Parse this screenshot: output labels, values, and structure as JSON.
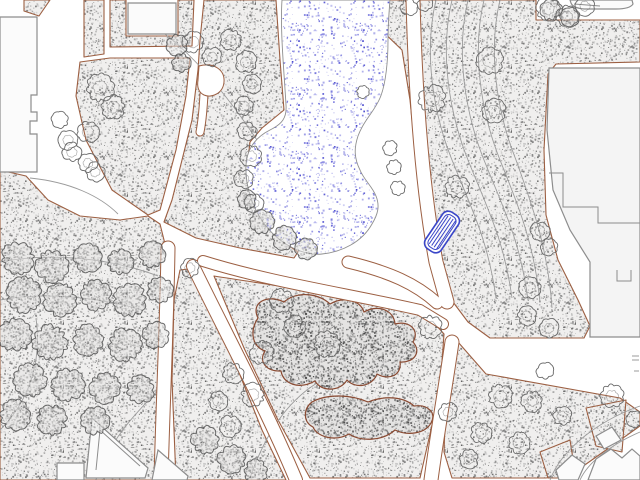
{
  "drawing": {
    "name": "park-site-plan",
    "viewport": {
      "w": 640,
      "h": 480
    }
  },
  "colors": {
    "paper": "#ffffff",
    "ground_base": "#f0efee",
    "ground_dots": [
      "#5c5c5c",
      "#7d7d7d",
      "#989898",
      "#b3b3b3",
      "#6e6e6e"
    ],
    "dark_base": "#e4e3e2",
    "dark_dots": [
      "#3d3d3d",
      "#565656",
      "#6f6f6f",
      "#8a8a8a"
    ],
    "pond_base": "#ffffff",
    "pond_dots": [
      "#3c3ccb",
      "#5656d6",
      "#8585e0",
      "#aaaae8"
    ],
    "edge_brown": "#9c5f42",
    "shrub_brown": "#8a4a32",
    "contour_gray": "#9b9b9b",
    "tree_gray": "#6a6a6a",
    "canopy_gray": "#525252",
    "building_stroke": "#8d8d8d",
    "building_fill": "#fbfbfb",
    "big_building_fill": "#f4f4f4",
    "pond_edge": "#8f8f8f",
    "bench_blue": "#3a46c8",
    "path_white": "#ffffff"
  },
  "grounds": [
    {
      "name": "strip-top-left-corner",
      "d": "M 24,0 L 50,0 L 39,16 L 24,11 Z"
    },
    {
      "name": "strip-top-left-vertical",
      "d": "M 84,0 L 104,0 L 104,54 L 84,57 Z"
    },
    {
      "name": "block-north",
      "d": "M 110,0 L 126,0 L 126,36 L 178,36 L 178,0 L 194,0 L 192,46 L 110,47 Z"
    },
    {
      "name": "wedge-west-of-pond",
      "d": "M 110,58 L 190,58 L 186,96 L 176,150 L 160,210 L 148,215 L 112,190 L 86,140 L 76,96 L 80,62 Z"
    },
    {
      "name": "pond-west-strip",
      "d": "M 204,0 L 276,0 L 280,60 L 284,110 L 262,128 L 250,142 L 247,168 L 252,196 L 266,222 L 284,242 L 298,252 L 294,258 L 240,248 L 196,238 L 164,222 L 172,200 L 182,160 L 192,120 L 198,70 L 200,40 Z"
    },
    {
      "name": "field-east",
      "d": "M 350,0 L 536,0 L 536,20 L 640,20 L 640,62 L 556,64 L 548,74 L 544,150 L 546,215 L 558,260 L 578,300 L 590,326 L 584,338 L 490,338 L 468,322 L 450,298 L 438,268 L 424,220 L 416,160 L 410,100 L 402,50 Z"
    },
    {
      "name": "field-southeast",
      "d": "M 458,342 L 486,374 L 620,398 L 640,412 L 640,426 L 572,474 L 546,478 L 452,478 L 444,452 L 446,396 Z"
    },
    {
      "name": "field-center-south",
      "d": "M 214,276 C 290,288 370,298 428,316 L 444,334 L 440,390 L 420,478 L 310,478 L 278,420 L 244,348 Z"
    },
    {
      "name": "field-between-paths",
      "d": "M 180,270 L 196,268 L 230,350 L 262,430 L 286,480 L 176,480 L 172,380 L 174,300 Z"
    },
    {
      "name": "field-west",
      "d": "M 0,170 L 26,176 L 48,200 L 80,216 L 120,220 L 148,216 L 160,224 L 165,244 L 160,330 L 156,480 L 0,480 Z"
    },
    {
      "name": "wedge-se-small-1",
      "d": "M 586,408 L 626,400 L 622,452 L 596,446 Z"
    },
    {
      "name": "wedge-se-small-2",
      "d": "M 540,452 L 570,440 L 576,478 L 548,478 Z"
    }
  ],
  "white_paths": [
    {
      "name": "path-east-of-pond",
      "d": "M 413,0 C 415,80 421,180 436,262 L 447,302",
      "w": 13
    },
    {
      "name": "path-to-junction",
      "d": "M 203,261 C 270,282 350,294 420,310 L 443,324",
      "w": 10
    },
    {
      "name": "path-under-pond",
      "d": "M 348,262 C 390,272 416,284 437,303",
      "w": 11
    },
    {
      "name": "path-junction-south",
      "d": "M 452,342 C 444,396 436,442 431,480",
      "w": 13
    },
    {
      "name": "path-center-south",
      "d": "M 193,266 C 224,330 266,408 296,480",
      "w": 12
    },
    {
      "name": "path-west-south",
      "d": "M 168,248 C 167,320 163,400 161,480",
      "w": 13
    },
    {
      "name": "path-bulb-stem",
      "d": "M 204,94 C 203,112 202,122 200,132",
      "w": 7
    }
  ],
  "white_shapes": [
    {
      "name": "path-bulb",
      "d": "M 199,66 C 214,62 225,70 224,82 C 223,94 211,98 204,95 C 198,92 197,86 198,80 Z"
    }
  ],
  "pond": {
    "name": "pond",
    "d": "M 282,0 C 280,30 284,70 286,105 C 287,118 282,124 270,130 C 254,138 247,150 246,165 C 245,185 252,208 266,226 C 282,246 305,256 322,254 C 342,252 362,242 372,224 C 378,214 380,206 376,196 C 372,186 364,180 360,170 C 354,158 354,148 358,136 C 364,120 374,112 380,98 C 386,84 388,60 388,40 C 388,26 389,12 390,0 Z"
  },
  "shrubs": [
    {
      "name": "shrub-mass-central",
      "d": "M 258,318 C 250,302 268,294 284,302 C 298,290 320,294 330,304 C 344,296 360,300 364,312 C 378,304 394,310 395,324 C 410,320 420,331 413,342 C 422,352 414,363 400,362 C 402,375 389,381 377,374 C 372,387 355,389 347,380 C 340,392 321,392 315,381 C 299,390 283,384 281,371 C 267,372 258,362 265,351 C 251,346 250,330 258,318 Z"
    },
    {
      "name": "shrub-mass-lower",
      "d": "M 312,402 C 328,393 352,395 368,402 C 386,395 404,397 414,406 C 428,404 437,413 431,423 C 425,434 407,436 395,430 C 383,441 361,442 349,434 C 335,442 317,437 313,427 C 303,422 303,409 312,402 Z"
    }
  ],
  "contours": [
    "M 436,0 C 424,50 432,110 452,160 C 472,210 488,240 496,298",
    "M 452,0 C 440,50 448,110 468,160 C 488,210 504,240 512,298",
    "M 468,0 C 456,50 464,110 484,160 C 504,210 520,240 528,300",
    "M 484,0 C 472,50 480,110 500,160 C 520,210 534,244 540,302",
    "M 500,0 C 488,50 496,110 516,160 C 534,210 548,250 552,308",
    "M 130,12 C 190,40 250,120 300,212",
    "M 30,178 C 70,182 100,196 118,214",
    "M 0,262 C 50,252 110,258 158,276",
    "M 0,300 C 40,292 95,296 142,310",
    "M 0,430 C 30,400 42,360 36,318",
    "M 96,480 C 112,432 148,402 164,384",
    "M 250,478 C 270,420 300,386 340,372",
    "M 640,406 C 600,420 562,448 550,480",
    "M 640,432 C 612,444 588,462 580,480",
    "M 632,356 L 639,356 M 632,360 L 639,360 M 634,371 L 639,371"
  ],
  "buildings": [
    {
      "name": "building-northwest",
      "big": false,
      "d": "M 0,17 L 37,17 L 37,95 L 31,95 L 31,112 L 37,112 L 37,121 L 30,121 L 30,134 L 37,134 L 37,172 L 0,172 Z"
    },
    {
      "name": "building-north-block",
      "big": false,
      "d": "M 128,3 L 176,3 L 176,34 L 128,34 Z"
    },
    {
      "name": "vehicle-north-east",
      "big": false,
      "d": "M 570,0 L 632,0 L 633,4 Q 630,9 616,9 L 584,9 Q 573,8 571,3 Z"
    },
    {
      "name": "building-east-large",
      "big": true,
      "d": "M 549,68 L 640,68 L 640,337 L 590,337 L 590,262 L 570,230 L 553,190 L 547,130 Z"
    },
    {
      "name": "building-se-1",
      "big": false,
      "d": "M 588,480 L 596,459 L 611,449 L 622,458 L 632,449 L 640,456 L 640,480 Z"
    },
    {
      "name": "building-se-2",
      "big": false,
      "d": "M 556,470 L 572,455 L 585,464 L 578,480 L 559,480 Z"
    },
    {
      "name": "building-se-3",
      "big": false,
      "d": "M 596,436 L 612,427 L 621,440 L 604,449 Z"
    },
    {
      "name": "building-southwest-a",
      "big": false,
      "d": "M 86,478 L 92,418 L 148,468 L 145,478 Z"
    },
    {
      "name": "building-southwest-b",
      "big": false,
      "d": "M 152,480 L 158,450 L 188,476 L 187,480 Z"
    },
    {
      "name": "building-south-small",
      "big": false,
      "d": "M 57,463 L 84,463 L 84,480 L 57,480 Z"
    }
  ],
  "building_details": [
    "M 549,173 L 563,173 L 563,207 L 598,207 L 598,223 L 640,223",
    "M 617,270 L 617,281 L 631,281 L 631,270",
    "M 96,470 L 100,430 L 140,466",
    "M 574,4 L 600,6"
  ],
  "trees": [
    [
      100,
      88,
      13,
      0
    ],
    [
      113,
      107,
      11,
      0
    ],
    [
      88,
      132,
      10,
      0
    ],
    [
      68,
      140,
      9,
      0
    ],
    [
      72,
      152,
      9,
      0
    ],
    [
      88,
      163,
      9,
      0
    ],
    [
      95,
      172,
      9,
      0
    ],
    [
      60,
      120,
      8,
      0
    ],
    [
      193,
      42,
      10,
      0
    ],
    [
      212,
      57,
      9,
      0
    ],
    [
      231,
      40,
      10,
      0
    ],
    [
      246,
      62,
      10,
      0
    ],
    [
      252,
      84,
      9,
      0
    ],
    [
      244,
      106,
      9,
      0
    ],
    [
      247,
      131,
      9,
      0
    ],
    [
      251,
      156,
      10,
      0
    ],
    [
      244,
      179,
      9,
      0
    ],
    [
      254,
      203,
      9,
      0
    ],
    [
      363,
      92,
      6,
      1
    ],
    [
      390,
      148,
      7,
      1
    ],
    [
      394,
      167,
      7,
      1
    ],
    [
      398,
      188,
      7,
      1
    ],
    [
      409,
      7,
      8,
      0
    ],
    [
      425,
      4,
      7,
      0
    ],
    [
      548,
      9,
      11,
      0
    ],
    [
      567,
      16,
      10,
      0
    ],
    [
      585,
      6,
      9,
      0
    ],
    [
      490,
      61,
      12,
      0
    ],
    [
      432,
      99,
      13,
      0
    ],
    [
      494,
      111,
      11,
      0
    ],
    [
      457,
      187,
      11,
      0
    ],
    [
      540,
      231,
      9,
      0
    ],
    [
      549,
      247,
      8,
      0
    ],
    [
      190,
      268,
      9,
      0
    ],
    [
      282,
      301,
      11,
      0
    ],
    [
      327,
      344,
      12,
      0
    ],
    [
      295,
      326,
      10,
      0
    ],
    [
      262,
      353,
      11,
      0
    ],
    [
      233,
      373,
      10,
      0
    ],
    [
      253,
      395,
      11,
      0
    ],
    [
      218,
      401,
      9,
      0
    ],
    [
      230,
      426,
      10,
      0
    ],
    [
      430,
      327,
      11,
      0
    ],
    [
      530,
      288,
      10,
      0
    ],
    [
      527,
      316,
      9,
      0
    ],
    [
      549,
      328,
      9,
      0
    ],
    [
      545,
      371,
      8,
      0
    ],
    [
      612,
      396,
      11,
      0
    ],
    [
      635,
      419,
      8,
      0
    ],
    [
      500,
      396,
      11,
      0
    ],
    [
      532,
      401,
      10,
      0
    ],
    [
      562,
      416,
      9,
      0
    ],
    [
      481,
      433,
      10,
      0
    ],
    [
      519,
      443,
      10,
      0
    ],
    [
      469,
      459,
      9,
      0
    ],
    [
      448,
      412,
      9,
      0
    ]
  ],
  "canopies": [
    [
      18,
      258,
      15
    ],
    [
      52,
      266,
      15
    ],
    [
      88,
      258,
      13
    ],
    [
      120,
      262,
      12
    ],
    [
      152,
      255,
      12
    ],
    [
      24,
      295,
      16
    ],
    [
      60,
      300,
      15
    ],
    [
      96,
      295,
      14
    ],
    [
      130,
      300,
      15
    ],
    [
      160,
      290,
      12
    ],
    [
      15,
      335,
      15
    ],
    [
      50,
      342,
      16
    ],
    [
      88,
      340,
      14
    ],
    [
      125,
      345,
      15
    ],
    [
      156,
      335,
      12
    ],
    [
      30,
      380,
      15
    ],
    [
      68,
      385,
      15
    ],
    [
      105,
      388,
      14
    ],
    [
      140,
      390,
      13
    ],
    [
      15,
      415,
      14
    ],
    [
      52,
      420,
      14
    ],
    [
      95,
      421,
      13
    ],
    [
      205,
      440,
      13
    ],
    [
      232,
      459,
      13
    ],
    [
      256,
      471,
      11
    ],
    [
      262,
      222,
      11
    ],
    [
      284,
      238,
      11
    ],
    [
      306,
      249,
      10
    ],
    [
      247,
      200,
      9
    ],
    [
      177,
      45,
      10
    ],
    [
      181,
      63,
      9
    ],
    [
      551,
      10,
      10
    ],
    [
      570,
      17,
      9
    ]
  ],
  "bench": {
    "name": "bench-selected",
    "cx": 442,
    "cy": 232,
    "w": 19,
    "h": 44,
    "rx": 7,
    "rot": 34,
    "inset": 3,
    "stripes": [
      -4,
      -1,
      2,
      5
    ]
  },
  "patterns": {
    "ground": {
      "tile": 64,
      "count": 520,
      "seed": 11,
      "smin": 0.7,
      "smax": 1.9
    },
    "dark": {
      "tile": 64,
      "count": 850,
      "seed": 23,
      "smin": 0.7,
      "smax": 2.0
    },
    "pond": {
      "tile": 64,
      "count": 230,
      "seed": 37,
      "smin": 0.8,
      "smax": 2.0
    }
  }
}
